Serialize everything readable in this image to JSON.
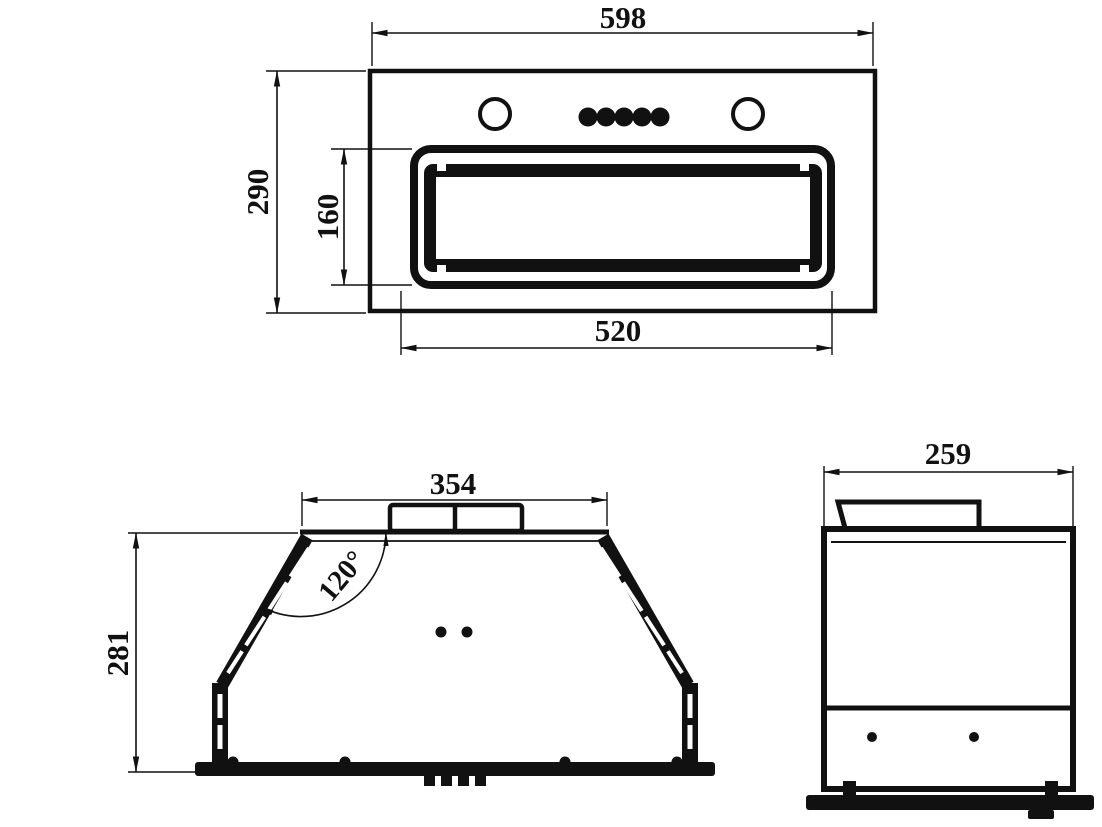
{
  "colors": {
    "line": "#111111",
    "background": "#ffffff"
  },
  "front_view": {
    "width": "598",
    "height": "290",
    "filter_width": "520",
    "filter_height": "160"
  },
  "profile_view": {
    "top_width": "354",
    "height": "281",
    "angle": "120°"
  },
  "side_view": {
    "depth": "259"
  }
}
